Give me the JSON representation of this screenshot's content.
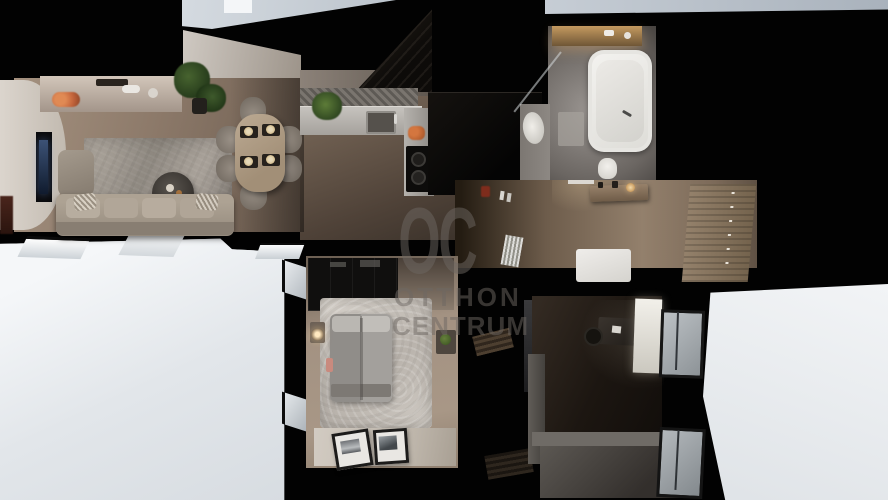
{
  "watermark": {
    "logo": "OC",
    "line1": "OTTHON",
    "line2": "CENTRUM",
    "color": "#6e6863",
    "opacity": "0.5"
  },
  "palette": {
    "walls_cut": "#020202",
    "exterior_light": "#eef1f4",
    "wood_floor_light": "#a4917f",
    "wood_floor_dark": "#4f4238",
    "bath_tile": "#8d8883",
    "tub_white": "#f0efec",
    "sofa_beige": "#a1968a",
    "living_rug_gray": "#9b948c",
    "bedroom_rug_white": "#d3cdc6",
    "kitchen_counter": "#b5b2ad",
    "unit_black": "#0b0908",
    "plant_green": "#44582e",
    "accent_orange": "#c4653c",
    "vanity_glow": "#b08954",
    "tv_screen_glow": "#31476b"
  }
}
